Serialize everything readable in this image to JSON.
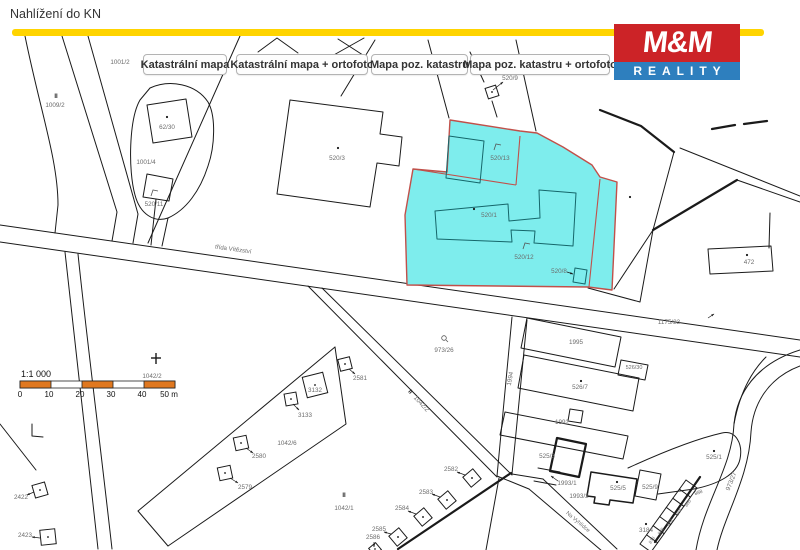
{
  "header": {
    "title": "Nahlížení do KN"
  },
  "logo": {
    "line1": "M&M",
    "line2": "REALITY",
    "red": "#CC2327",
    "blue": "#2E7FBE"
  },
  "toolbar": {
    "buttons": [
      "Katastrální mapa",
      "Katastrální mapa + ortofoto",
      "Mapa poz. katastru",
      "Mapa poz. katastru + ortofoto"
    ]
  },
  "scalebar": {
    "ratio": "1:1 000",
    "ticks": [
      "0",
      "10",
      "20",
      "30",
      "40",
      "50 m"
    ],
    "orange": "#E07820"
  },
  "map": {
    "highlight_fill": "#7EEDED",
    "highlight_stroke": "#C1504A",
    "highlighted_parcels": [
      "520/13",
      "520/1",
      "520/12",
      "520/8"
    ],
    "labels": [
      {
        "text": "1001/2",
        "x": 120,
        "y": 64
      },
      {
        "text": "II",
        "x": 56,
        "y": 98,
        "size": 6,
        "bold": true,
        "color": "#222"
      },
      {
        "text": "1009/2",
        "x": 55,
        "y": 107
      },
      {
        "text": "62/30",
        "x": 167,
        "y": 129
      },
      {
        "text": "1001/4",
        "x": 146,
        "y": 164
      },
      {
        "text": "520/11",
        "x": 154,
        "y": 206
      },
      {
        "text": "520/3",
        "x": 337,
        "y": 160
      },
      {
        "text": "520/9",
        "x": 510,
        "y": 80
      },
      {
        "text": "520/13",
        "x": 500,
        "y": 160
      },
      {
        "text": "520/1",
        "x": 489,
        "y": 217
      },
      {
        "text": "520/12",
        "x": 524,
        "y": 259
      },
      {
        "text": "520/8",
        "x": 559,
        "y": 273
      },
      {
        "text": "472",
        "x": 749,
        "y": 264
      },
      {
        "text": "1175/23",
        "x": 669,
        "y": 324
      },
      {
        "text": "třída Vítězství",
        "x": 233,
        "y": 251,
        "rot": 8,
        "size": 6
      },
      {
        "text": "973/26",
        "x": 444,
        "y": 352
      },
      {
        "text": "1995",
        "x": 576,
        "y": 344
      },
      {
        "text": "1994",
        "x": 512,
        "y": 379,
        "rot": -80
      },
      {
        "text": "526/30",
        "x": 634,
        "y": 369,
        "size": 5.5
      },
      {
        "text": "526/7",
        "x": 580,
        "y": 389
      },
      {
        "text": "1992",
        "x": 562,
        "y": 424
      },
      {
        "text": "525/3",
        "x": 547,
        "y": 458
      },
      {
        "text": "1993/1",
        "x": 567,
        "y": 485
      },
      {
        "text": "1993/2",
        "x": 579,
        "y": 498
      },
      {
        "text": "525/5",
        "x": 618,
        "y": 490
      },
      {
        "text": "525/9",
        "x": 650,
        "y": 489
      },
      {
        "text": "525/1",
        "x": 714,
        "y": 459
      },
      {
        "text": "3184",
        "x": 646,
        "y": 532
      },
      {
        "text": "888",
        "x": 699,
        "y": 494,
        "rot": -20,
        "size": 5
      },
      {
        "text": "886",
        "x": 689,
        "y": 504,
        "rot": -55,
        "size": 4.5
      },
      {
        "text": "884",
        "x": 680,
        "y": 513,
        "rot": -55,
        "size": 4.5
      },
      {
        "text": "882",
        "x": 671,
        "y": 523,
        "rot": -55,
        "size": 4.5
      },
      {
        "text": "880",
        "x": 662,
        "y": 532,
        "rot": -55,
        "size": 4.5
      },
      {
        "text": "878",
        "x": 653,
        "y": 541,
        "rot": -55,
        "size": 4.5
      },
      {
        "text": "973/27",
        "x": 733,
        "y": 482,
        "rot": -68
      },
      {
        "text": "Na Vyhlídce",
        "x": 577,
        "y": 523,
        "rot": 40,
        "size": 5.5
      },
      {
        "text": "1042/2",
        "x": 152,
        "y": 378
      },
      {
        "text": "1042/2",
        "x": 420,
        "y": 405,
        "rot": 47
      },
      {
        "text": "II",
        "x": 409,
        "y": 393,
        "rot": 47,
        "size": 6,
        "bold": true,
        "color": "#222"
      },
      {
        "text": "1042/6",
        "x": 287,
        "y": 445
      },
      {
        "text": "1042/1",
        "x": 344,
        "y": 510
      },
      {
        "text": "II",
        "x": 344,
        "y": 497,
        "size": 6,
        "bold": true,
        "color": "#222"
      },
      {
        "text": "2581",
        "x": 360,
        "y": 380
      },
      {
        "text": "3132",
        "x": 315,
        "y": 392
      },
      {
        "text": "3133",
        "x": 305,
        "y": 417
      },
      {
        "text": "2580",
        "x": 259,
        "y": 458
      },
      {
        "text": "2579",
        "x": 245,
        "y": 489
      },
      {
        "text": "2422",
        "x": 21,
        "y": 499
      },
      {
        "text": "2423",
        "x": 25,
        "y": 537
      },
      {
        "text": "2582",
        "x": 451,
        "y": 471
      },
      {
        "text": "2583",
        "x": 426,
        "y": 494
      },
      {
        "text": "2584",
        "x": 402,
        "y": 510
      },
      {
        "text": "2585",
        "x": 379,
        "y": 531
      },
      {
        "text": "2586",
        "x": 373,
        "y": 539
      }
    ]
  }
}
